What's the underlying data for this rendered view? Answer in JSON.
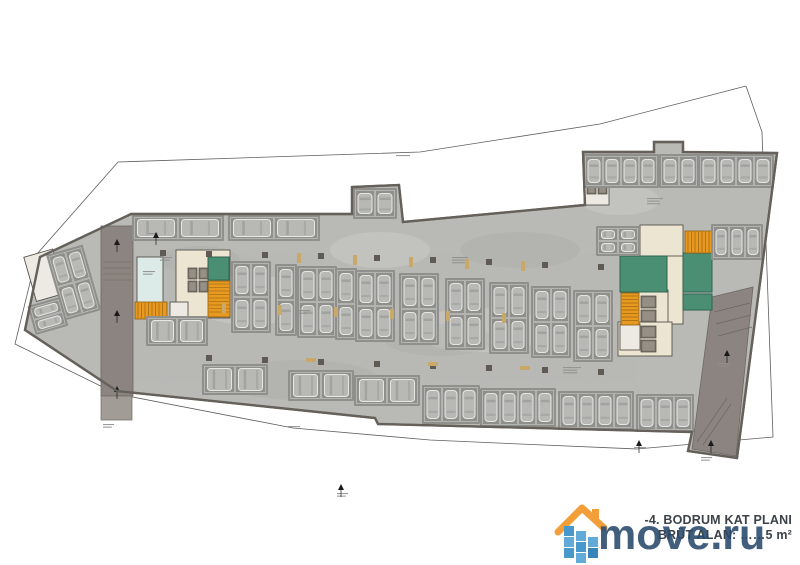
{
  "title_block": {
    "line1": "-4. BODRUM KAT PLANI",
    "line2": "BRÜT ALAN: ……5 m²"
  },
  "watermark": {
    "text": "move.ru",
    "text_color": "#27496b",
    "roof_color": "#f2992f",
    "pixel_colors": [
      "#3f93c9",
      "#5aa6d6",
      "#2e7fb8"
    ],
    "pixels": [
      [
        10,
        26,
        0
      ],
      [
        10,
        37,
        1
      ],
      [
        10,
        48,
        0
      ],
      [
        22,
        31,
        1
      ],
      [
        22,
        42,
        0
      ],
      [
        22,
        53,
        1
      ],
      [
        34,
        37,
        1
      ],
      [
        34,
        48,
        2
      ]
    ]
  },
  "colors": {
    "floor": "#c7c7c4",
    "wall": "#65615a",
    "stall": "#8f8f8c",
    "stall_line": "#c2c2bf",
    "car": "#b8b8b5",
    "car_edge": "#e6e6e3",
    "car_glass": "#9d9d9a",
    "ramp": "#8b8480",
    "ramp_light": "#a29c97",
    "boundary": "#5f5f5f",
    "cream": "#ece5d2",
    "mint": "#dcebe7",
    "green": "#4a8f74",
    "green_edge": "#2e6450",
    "orange": "#e8991f",
    "orange_edge": "#8a5c12",
    "white_room": "#eceae2",
    "column": "#5f5b54",
    "tan": "#c9a96a",
    "lift": "#7d7870",
    "micro": "#8f8f8c",
    "room_edge": "#57534b",
    "marker": "#1a1a1a"
  },
  "plan": {
    "boundary": "746,86 600,124 420,152 118,162 37,254 15,344 117,394 293,428 430,440 520,444 637,449 773,437 762,132 746,86",
    "outline": "M131,214 L352,214 L352,187 L399,185 L403,222 L585,205 L583,152 L654,152 L654,142 L683,142 L683,152 L777,153 L737,458 L688,451 L692,432 L378,424 L375,418 L117,391 L25,330 L40,257 Z",
    "left_ramp": {
      "x": 101,
      "y": 226,
      "w": 32,
      "h": 170,
      "ext_y": 396,
      "ext_h": 24
    },
    "right_ramp": {
      "points": "712,297 753,287 736,456 692,449"
    },
    "hatch_left": [
      [
        103,
        262,
        131,
        262
      ],
      [
        103,
        268,
        131,
        268
      ],
      [
        103,
        274,
        131,
        274
      ],
      [
        103,
        280,
        131,
        280
      ]
    ],
    "hatch_right": [
      [
        714,
        312,
        750,
        303
      ],
      [
        716,
        324,
        751,
        315
      ],
      [
        718,
        336,
        752,
        327
      ],
      [
        697,
        442,
        727,
        398
      ],
      [
        703,
        445,
        731,
        404
      ]
    ],
    "rooms": [
      {
        "x": 640,
        "y": 225,
        "w": 43,
        "h": 33,
        "c": "cream"
      },
      {
        "x": 665,
        "y": 256,
        "w": 18,
        "h": 68,
        "c": "cream"
      },
      {
        "x": 638,
        "y": 290,
        "w": 30,
        "h": 64,
        "c": "cream"
      },
      {
        "x": 618,
        "y": 322,
        "w": 54,
        "h": 34,
        "c": "cream"
      },
      {
        "x": 176,
        "y": 250,
        "w": 54,
        "h": 68,
        "c": "cream"
      },
      {
        "x": 137,
        "y": 257,
        "w": 26,
        "h": 47,
        "c": "mint"
      },
      {
        "x": 170,
        "y": 302,
        "w": 18,
        "h": 16,
        "c": "white"
      },
      {
        "x": 620,
        "y": 324,
        "w": 20,
        "h": 26,
        "c": "white"
      },
      {
        "x": 585,
        "y": 183,
        "w": 24,
        "h": 22,
        "c": "white"
      },
      {
        "x": 208,
        "y": 257,
        "w": 21,
        "h": 23,
        "c": "green"
      },
      {
        "x": 620,
        "y": 256,
        "w": 47,
        "h": 36,
        "c": "green"
      },
      {
        "x": 683,
        "y": 253,
        "w": 29,
        "h": 39,
        "c": "green"
      },
      {
        "x": 683,
        "y": 294,
        "w": 29,
        "h": 16,
        "c": "green"
      },
      {
        "x": 36,
        "y": 246,
        "w": 30,
        "h": 46,
        "c": "white",
        "rot": -16,
        "px": 70,
        "py": 295
      }
    ],
    "stairs": [
      {
        "x": 135,
        "y": 302,
        "w": 32,
        "h": 17,
        "dir": "h"
      },
      {
        "x": 208,
        "y": 281,
        "w": 22,
        "h": 36,
        "dir": "v"
      },
      {
        "x": 685,
        "y": 231,
        "w": 27,
        "h": 22,
        "dir": "h"
      },
      {
        "x": 621,
        "y": 293,
        "w": 18,
        "h": 32,
        "dir": "v"
      }
    ],
    "lifts": [
      {
        "x": 188,
        "y": 268,
        "w": 9,
        "h": 11
      },
      {
        "x": 199,
        "y": 268,
        "w": 9,
        "h": 11
      },
      {
        "x": 188,
        "y": 281,
        "w": 9,
        "h": 11
      },
      {
        "x": 199,
        "y": 281,
        "w": 9,
        "h": 11
      },
      {
        "x": 641,
        "y": 296,
        "w": 15,
        "h": 12
      },
      {
        "x": 641,
        "y": 310,
        "w": 15,
        "h": 12
      },
      {
        "x": 641,
        "y": 326,
        "w": 15,
        "h": 12
      },
      {
        "x": 641,
        "y": 340,
        "w": 15,
        "h": 12
      },
      {
        "x": 587,
        "y": 186,
        "w": 9,
        "h": 8
      },
      {
        "x": 598,
        "y": 186,
        "w": 9,
        "h": 8
      }
    ],
    "blocks": [
      {
        "x": 134,
        "y": 217,
        "c": 2,
        "r": 1,
        "cw": 44,
        "ch": 22,
        "dir": "h"
      },
      {
        "x": 230,
        "y": 217,
        "c": 2,
        "r": 1,
        "cw": 44,
        "ch": 22,
        "dir": "h"
      },
      {
        "x": 355,
        "y": 190,
        "c": 2,
        "r": 1,
        "cw": 20,
        "ch": 27,
        "dir": "v"
      },
      {
        "x": 585,
        "y": 156,
        "c": 4,
        "r": 1,
        "cw": 18,
        "ch": 30,
        "dir": "v"
      },
      {
        "x": 661,
        "y": 156,
        "c": 2,
        "r": 1,
        "cw": 18,
        "ch": 30,
        "dir": "v"
      },
      {
        "x": 700,
        "y": 156,
        "c": 4,
        "r": 1,
        "cw": 18,
        "ch": 30,
        "dir": "v"
      },
      {
        "x": 713,
        "y": 226,
        "c": 3,
        "r": 1,
        "cw": 16,
        "ch": 32,
        "dir": "v"
      },
      {
        "x": 598,
        "y": 228,
        "c": 2,
        "r": 2,
        "cw": 20,
        "ch": 13,
        "dir": "h"
      },
      {
        "x": 233,
        "y": 263,
        "c": 2,
        "r": 2,
        "cw": 18,
        "ch": 34,
        "dir": "v"
      },
      {
        "x": 277,
        "y": 266,
        "c": 1,
        "r": 2,
        "cw": 18,
        "ch": 34,
        "dir": "v"
      },
      {
        "x": 299,
        "y": 268,
        "c": 2,
        "r": 2,
        "cw": 18,
        "ch": 34,
        "dir": "v"
      },
      {
        "x": 337,
        "y": 270,
        "c": 1,
        "r": 2,
        "cw": 18,
        "ch": 34,
        "dir": "v"
      },
      {
        "x": 357,
        "y": 272,
        "c": 2,
        "r": 2,
        "cw": 18,
        "ch": 34,
        "dir": "v"
      },
      {
        "x": 401,
        "y": 275,
        "c": 2,
        "r": 2,
        "cw": 18,
        "ch": 34,
        "dir": "v"
      },
      {
        "x": 447,
        "y": 280,
        "c": 2,
        "r": 2,
        "cw": 18,
        "ch": 34,
        "dir": "v"
      },
      {
        "x": 491,
        "y": 284,
        "c": 2,
        "r": 2,
        "cw": 18,
        "ch": 34,
        "dir": "v"
      },
      {
        "x": 533,
        "y": 288,
        "c": 2,
        "r": 2,
        "cw": 18,
        "ch": 34,
        "dir": "v"
      },
      {
        "x": 575,
        "y": 292,
        "c": 2,
        "r": 2,
        "cw": 18,
        "ch": 34,
        "dir": "v"
      },
      {
        "x": 148,
        "y": 318,
        "c": 2,
        "r": 1,
        "cw": 29,
        "ch": 26,
        "dir": "h"
      },
      {
        "x": 204,
        "y": 366,
        "c": 2,
        "r": 1,
        "cw": 31,
        "ch": 27,
        "dir": "h"
      },
      {
        "x": 290,
        "y": 372,
        "c": 2,
        "r": 1,
        "cw": 31,
        "ch": 27,
        "dir": "h"
      },
      {
        "x": 356,
        "y": 377,
        "c": 2,
        "r": 1,
        "cw": 31,
        "ch": 27,
        "dir": "h"
      },
      {
        "x": 424,
        "y": 387,
        "c": 3,
        "r": 1,
        "cw": 18,
        "ch": 35,
        "dir": "v"
      },
      {
        "x": 482,
        "y": 390,
        "c": 4,
        "r": 1,
        "cw": 18,
        "ch": 35,
        "dir": "v"
      },
      {
        "x": 560,
        "y": 393,
        "c": 4,
        "r": 1,
        "cw": 18,
        "ch": 35,
        "dir": "v"
      },
      {
        "x": 638,
        "y": 396,
        "c": 3,
        "r": 1,
        "cw": 18,
        "ch": 34,
        "dir": "v"
      },
      {
        "x": 60,
        "y": 252,
        "c": 2,
        "r": 2,
        "cw": 17,
        "ch": 32,
        "dir": "v",
        "rot": -16,
        "px": 70,
        "py": 295
      },
      {
        "x": 28,
        "y": 296,
        "c": 1,
        "r": 2,
        "cw": 30,
        "ch": 13,
        "dir": "h",
        "rot": -16,
        "px": 70,
        "py": 295
      }
    ],
    "columns": [
      [
        206,
        251
      ],
      [
        262,
        252
      ],
      [
        318,
        253
      ],
      [
        374,
        255
      ],
      [
        430,
        257
      ],
      [
        486,
        259
      ],
      [
        160,
        250
      ],
      [
        542,
        262
      ],
      [
        598,
        264
      ],
      [
        206,
        355
      ],
      [
        262,
        357
      ],
      [
        318,
        359
      ],
      [
        374,
        361
      ],
      [
        430,
        363
      ],
      [
        486,
        365
      ],
      [
        542,
        367
      ],
      [
        598,
        369
      ]
    ],
    "tan_walls": [
      {
        "x": 297,
        "y": 253,
        "w": 4,
        "h": 10
      },
      {
        "x": 353,
        "y": 255,
        "w": 4,
        "h": 10
      },
      {
        "x": 409,
        "y": 257,
        "w": 4,
        "h": 10
      },
      {
        "x": 465,
        "y": 259,
        "w": 4,
        "h": 10
      },
      {
        "x": 521,
        "y": 261,
        "w": 4,
        "h": 10
      },
      {
        "x": 222,
        "y": 303,
        "w": 4,
        "h": 10
      },
      {
        "x": 278,
        "y": 305,
        "w": 4,
        "h": 10
      },
      {
        "x": 334,
        "y": 307,
        "w": 4,
        "h": 10
      },
      {
        "x": 390,
        "y": 309,
        "w": 4,
        "h": 10
      },
      {
        "x": 446,
        "y": 311,
        "w": 4,
        "h": 10
      },
      {
        "x": 502,
        "y": 313,
        "w": 4,
        "h": 10
      },
      {
        "x": 306,
        "y": 358,
        "w": 10,
        "h": 4
      },
      {
        "x": 428,
        "y": 362,
        "w": 10,
        "h": 4
      },
      {
        "x": 520,
        "y": 366,
        "w": 10,
        "h": 4
      }
    ],
    "micro_labels": [
      [
        160,
        257,
        12,
        2
      ],
      [
        452,
        257,
        16,
        3
      ],
      [
        297,
        310,
        13,
        2
      ],
      [
        563,
        367,
        18,
        3
      ],
      [
        647,
        198,
        16,
        3
      ],
      [
        396,
        155,
        14,
        1
      ],
      [
        288,
        426,
        12,
        1
      ],
      [
        634,
        447,
        12,
        1
      ],
      [
        701,
        457,
        11,
        2
      ],
      [
        103,
        424,
        11,
        2
      ],
      [
        337,
        493,
        11,
        2
      ],
      [
        149,
        233,
        9,
        1
      ],
      [
        718,
        363,
        12,
        2
      ],
      [
        143,
        271,
        12,
        2
      ]
    ],
    "markers": [
      [
        117,
        243
      ],
      [
        117,
        314
      ],
      [
        727,
        354
      ],
      [
        711,
        444
      ],
      [
        156,
        236
      ],
      [
        117,
        390
      ],
      [
        341,
        488
      ],
      [
        639,
        444
      ]
    ],
    "light_patches": [
      [
        250,
        300,
        60,
        25
      ],
      [
        480,
        330,
        70,
        22
      ],
      [
        620,
        200,
        40,
        15
      ],
      [
        380,
        250,
        50,
        18
      ],
      [
        560,
        410,
        45,
        15
      ]
    ],
    "dark_patches": [
      [
        300,
        380,
        80,
        20
      ],
      [
        520,
        250,
        60,
        18
      ],
      [
        200,
        260,
        40,
        14
      ],
      [
        440,
        340,
        55,
        16
      ]
    ]
  }
}
